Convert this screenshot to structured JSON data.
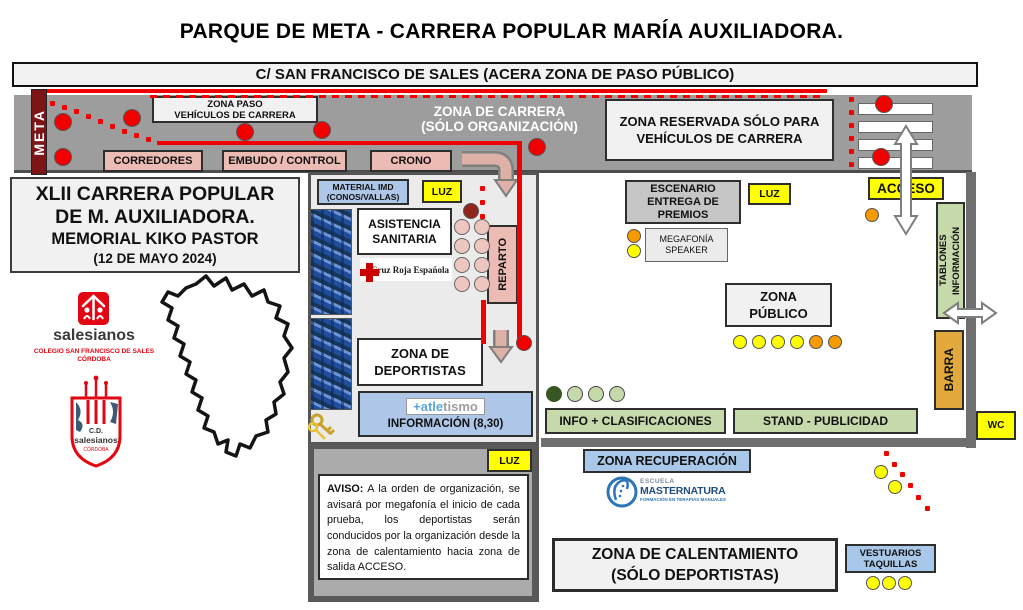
{
  "title": "PARQUE DE META - CARRERA POPULAR MARÍA AUXILIADORA.",
  "street": "C/ SAN FRANCISCO DE SALES (ACERA ZONA DE PASO PÚBLICO)",
  "meta_sign": "META",
  "band": {
    "zona_paso": [
      "ZONA PASO",
      "VEHÍCULOS DE CARRERA"
    ],
    "corredores": "CORREDORES",
    "embudo": "EMBUDO / CONTROL",
    "crono": "CRONO",
    "zona_carrera": [
      "ZONA DE CARRERA",
      "(SÓLO ORGANIZACIÓN)"
    ],
    "zona_reservada": [
      "ZONA RESERVADA SÓLO PARA",
      "VEHÍCULOS DE CARRERA"
    ]
  },
  "info_box": {
    "l1": "XLII CARRERA POPULAR",
    "l2": "DE M. AUXILIADORA.",
    "l3": "MEMORIAL KIKO PASTOR",
    "l4": "(12 DE MAYO 2024)"
  },
  "logos": {
    "salesianos": "salesianos",
    "colegio": [
      "COLEGIO SAN FRANCISCO DE SALES",
      "CÓRDOBA"
    ],
    "crest": [
      "C.D.",
      "salesianos",
      "CÓRDOBA"
    ]
  },
  "central": {
    "material": [
      "MATERIAL IMD",
      "(CONOS/VALLAS)"
    ],
    "luz": "LUZ",
    "asistencia": [
      "ASISTENCIA",
      "SANITARIA"
    ],
    "cruz_roja": "Cruz Roja Española",
    "reparto": "REPARTO",
    "deportistas": [
      "ZONA DE",
      "DEPORTISTAS"
    ],
    "atletismo_blue": "+atle",
    "atletismo_gray": "tismo",
    "informacion": "INFORMACIÓN (8,30)"
  },
  "right": {
    "escenario": [
      "ESCENARIO",
      "ENTREGA DE",
      "PREMIOS"
    ],
    "luz": "LUZ",
    "megafonia": [
      "MEGAFONÍA",
      "SPEAKER"
    ],
    "zona_publico": [
      "ZONA",
      "PÚBLICO"
    ],
    "acceso": "ACCESO",
    "tablones": "TABLONES INFORMACIÓN",
    "barra": "BARRA",
    "wc": "WC",
    "info_clasificaciones": "INFO + CLASIFICACIONES",
    "stand": "STAND - PUBLICIDAD"
  },
  "bottom": {
    "luz": "LUZ",
    "aviso_label": "AVISO:",
    "aviso_text": " A la orden de organización, se avisará por megafonía el inicio de cada prueba, los deportistas serán conducidos por la organización desde la zona de calentamiento hacia zona de salida ACCESO.",
    "recuperacion": "ZONA RECUPERACIÓN",
    "masternatura": [
      "ESCUELA",
      "MASTERNATURA",
      "FORMACIÓN EN TERAPIAS MANUALES"
    ],
    "calentamiento": [
      "ZONA DE CALENTAMIENTO",
      "(SÓLO DEPORTISTAS)"
    ],
    "vestuarios": [
      "VESTUARIOS",
      "TAQUILLAS"
    ]
  },
  "colors": {
    "route_red": "#f20000",
    "band_gray": "#9d9d9d",
    "luz_yellow": "#ffff00",
    "zone_green": "#c6d9ab",
    "zone_blue": "#aec6e8",
    "zone_pink": "#ecbcb4",
    "barra_gold": "#e3a93d",
    "meta_maroon": "#7d1517",
    "salesianos_red": "#e30613",
    "masternatura_blue": "#1f4e79"
  },
  "markers": [
    {
      "name": "band-red-circle",
      "color": "#f20000",
      "stroke": "#555",
      "r": 9,
      "points": [
        [
          63,
          122
        ],
        [
          132,
          118
        ],
        [
          63,
          157
        ],
        [
          245,
          132
        ],
        [
          322,
          130
        ],
        [
          537,
          147
        ],
        [
          884,
          104
        ],
        [
          881,
          157
        ]
      ]
    },
    {
      "name": "route-end-red-circle",
      "color": "#f20000",
      "stroke": "#555",
      "r": 8,
      "points": [
        [
          524,
          343
        ]
      ]
    },
    {
      "name": "dark-red-circle",
      "color": "#90261c",
      "stroke": "#555",
      "r": 8,
      "points": [
        [
          471,
          211
        ]
      ]
    },
    {
      "name": "pink-circle",
      "color": "#eec6c0",
      "stroke": "#666",
      "r": 8,
      "points": [
        [
          462,
          227
        ],
        [
          482,
          227
        ],
        [
          462,
          246
        ],
        [
          482,
          246
        ],
        [
          462,
          265
        ],
        [
          482,
          265
        ],
        [
          462,
          284
        ],
        [
          482,
          284
        ]
      ]
    },
    {
      "name": "orange-circle",
      "color": "#f59b00",
      "stroke": "#555",
      "r": 7,
      "points": [
        [
          634,
          236
        ],
        [
          872,
          215
        ],
        [
          816,
          342
        ],
        [
          835,
          342
        ]
      ]
    },
    {
      "name": "yellow-circle",
      "color": "#ffff00",
      "stroke": "#555",
      "r": 7,
      "points": [
        [
          634,
          251
        ],
        [
          740,
          342
        ],
        [
          759,
          342
        ],
        [
          778,
          342
        ],
        [
          797,
          342
        ],
        [
          881,
          472
        ],
        [
          895,
          487
        ],
        [
          873,
          583
        ],
        [
          889,
          583
        ],
        [
          905,
          583
        ]
      ]
    },
    {
      "name": "green-circle-filled",
      "color": "#375623",
      "stroke": "#375623",
      "r": 8,
      "points": [
        [
          554,
          394
        ]
      ]
    },
    {
      "name": "green-circle",
      "color": "#c6d9ab",
      "stroke": "#444",
      "r": 8,
      "points": [
        [
          575,
          394
        ],
        [
          596,
          394
        ],
        [
          617,
          394
        ]
      ]
    }
  ],
  "dots": [
    {
      "name": "meta-dotted-diagonal",
      "color": "#f20000",
      "size": 5,
      "points": [
        [
          52,
          103
        ],
        [
          64,
          107
        ],
        [
          76,
          111
        ],
        [
          88,
          116
        ],
        [
          100,
          121
        ],
        [
          112,
          126
        ],
        [
          124,
          131
        ],
        [
          136,
          135
        ],
        [
          148,
          139
        ]
      ]
    },
    {
      "name": "reparto-dotted",
      "color": "#f20000",
      "size": 5,
      "points": [
        [
          482,
          188
        ],
        [
          482,
          202
        ],
        [
          482,
          216
        ]
      ]
    },
    {
      "name": "reserved-dotted-vertical",
      "color": "#f20000",
      "size": 5,
      "points": [
        [
          851,
          99
        ],
        [
          851,
          112
        ],
        [
          851,
          125
        ],
        [
          851,
          138
        ],
        [
          851,
          151
        ],
        [
          851,
          164
        ]
      ]
    },
    {
      "name": "bottom-dotted-diagonal",
      "color": "#f20000",
      "size": 5,
      "points": [
        [
          886,
          453
        ],
        [
          894,
          464
        ],
        [
          902,
          474
        ],
        [
          910,
          485
        ],
        [
          918,
          497
        ],
        [
          927,
          508
        ]
      ]
    }
  ]
}
